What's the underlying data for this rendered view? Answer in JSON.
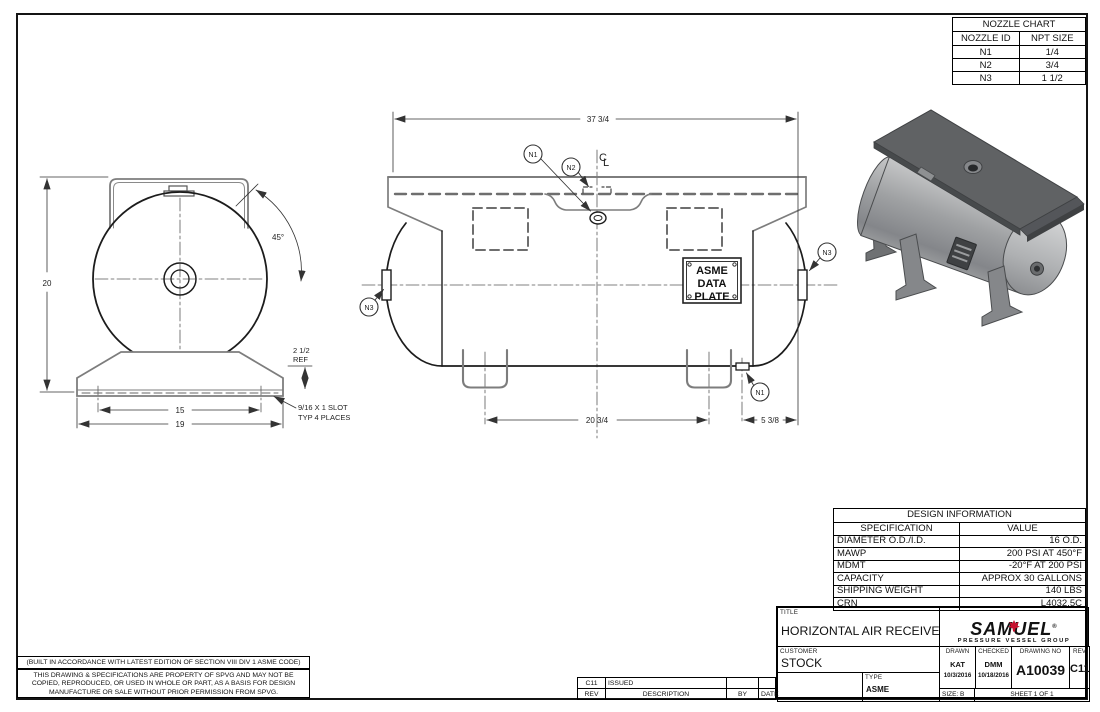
{
  "nozzle_chart": {
    "title": "NOZZLE CHART",
    "col_id": "NOZZLE ID",
    "col_size": "NPT SIZE",
    "rows": [
      {
        "id": "N1",
        "size": "1/4"
      },
      {
        "id": "N2",
        "size": "3/4"
      },
      {
        "id": "N3",
        "size": "1 1/2"
      }
    ]
  },
  "design_info": {
    "title": "DESIGN INFORMATION",
    "col_spec": "SPECIFICATION",
    "col_value": "VALUE",
    "rows": [
      {
        "spec": "DIAMETER O.D./I.D.",
        "value": "16 O.D."
      },
      {
        "spec": "MAWP",
        "value": "200 PSI AT 450°F"
      },
      {
        "spec": "MDMT",
        "value": "-20°F AT 200 PSI"
      },
      {
        "spec": "CAPACITY",
        "value": "APPROX 30 GALLONS"
      },
      {
        "spec": "SHIPPING WEIGHT",
        "value": "140 LBS"
      },
      {
        "spec": "CRN",
        "value": "L4032.5C"
      }
    ]
  },
  "title_block": {
    "title_label": "TITLE",
    "title": "HORIZONTAL AIR RECEIVER",
    "customer_label": "CUSTOMER",
    "customer": "STOCK",
    "type_label": "TYPE",
    "type": "ASME",
    "drawn_label": "DRAWN",
    "drawn_by": "KAT",
    "drawn_date": "10/3/2016",
    "checked_label": "CHECKED",
    "checked_by": "DMM",
    "checked_date": "10/18/2016",
    "drawing_no_label": "DRAWING NO",
    "drawing_no": "A10039",
    "rev_label": "REV",
    "rev": "C11",
    "size": "SIZE: B",
    "sheet": "SHEET 1  OF 1",
    "logo": {
      "name": "SAMUEL",
      "reg": "®",
      "tagline": "PRESSURE VESSEL GROUP",
      "accent": "#c8102e"
    }
  },
  "revision_table": {
    "rev": "C11",
    "description": "ISSUED",
    "by": "",
    "date": "",
    "rev_label": "REV",
    "description_label": "DESCRIPTION",
    "by_label": "BY",
    "date_label": "DATE"
  },
  "notes": {
    "code_note": "(BUILT IN ACCORDANCE WITH LATEST EDITION OF SECTION VIII DIV 1 ASME CODE)",
    "property_lines": [
      "THIS DRAWING & SPECIFICATIONS ARE PROPERTY OF SPVG AND MAY NOT BE",
      "COPIED, REPRODUCED, OR USED IN WHOLE OR PART, AS A BASIS FOR DESIGN",
      "MANUFACTURE OR SALE WITHOUT PRIOR PERMISSION FROM SPVG."
    ]
  },
  "drawing": {
    "balloons": {
      "n1": "N1",
      "n2": "N2",
      "n3": "N3"
    },
    "centerline": {
      "c": "C",
      "l": "L"
    },
    "data_plate": {
      "line1": "ASME",
      "line2": "DATA",
      "line3": "PLATE"
    },
    "dims": {
      "overall_length": "37 3/4",
      "leg_spacing": "20 3/4",
      "end_offset": "5 3/8",
      "height": "20",
      "base_inner": "15",
      "base_outer": "19",
      "ref_height_1": "2 1/2",
      "ref_height_2": "REF",
      "slot_note_1": "9/16 X 1 SLOT",
      "slot_note_2": "TYP 4 PLACES",
      "angle": "45°"
    }
  }
}
